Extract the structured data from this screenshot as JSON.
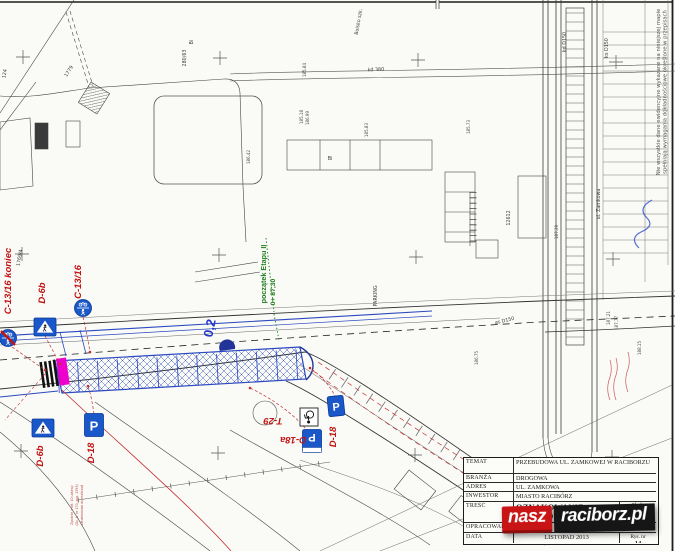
{
  "colors": {
    "design_blue": "#2b49c0",
    "sign_blue": "#1a57c8",
    "label_red": "#c21414",
    "station_green": "#1e7d1e",
    "crossing_magenta": "#ee00cc",
    "pen_blue": "#3355cc"
  },
  "map_labels": [
    "124",
    "1769/4",
    "1779",
    "280/63",
    "Bi",
    "Boisko szk.",
    "kd 380",
    "kd D150",
    "ks D150",
    "ul. Zamkowa",
    "12612",
    "øs D150",
    "PARKING",
    "185.18",
    "186.99",
    "185.83",
    "185.73",
    "187.39",
    "185.84",
    "186.42",
    "187.21",
    "187.77",
    "188.15",
    "186.75"
  ],
  "signs": {
    "c1316_koniec": "C-13/16 koniec",
    "c1316": "C-13/16",
    "d6b": "D-6b",
    "d18": "D-18",
    "d18a": "D-18a",
    "t29": "T-29",
    "p_letter": "P"
  },
  "stationing": {
    "label": "początek Etapu II",
    "chainage": "0+ 87,30"
  },
  "road_marking": {
    "width_label": "0,2"
  },
  "disclaimer": {
    "line1": "Nie wszystkie dane ewidencyjne wykazane na niniejszej mapie",
    "line2": "spełniają wymagania dokładnościowe określone w przepisach"
  },
  "legal_note": {
    "line1": "Zgodnie z art. 10 ustawy",
    "line2": "(Dz. U. nr 170, poz. 1393)",
    "line3": "zatwierdzam do realizacji"
  },
  "title_block": {
    "temat_label": "TEMAT",
    "temat_value": "PRZEBUDOWA UL. ZAMKOWEJ W RACIBORZU",
    "branza_label": "BRANŻA",
    "branza_value": "DROGOWA",
    "adres_label": "ADRES",
    "adres_value": "UL. ZAMKOWA",
    "inwestor_label": "INWESTOR",
    "inwestor_value": "MIASTO RACIBÓRZ",
    "tresc_label": "TREŚĆ",
    "tresc_value_line1": "OZNAKOWANIE",
    "tresc_value_line2": "DOCELOWE - ETAP II",
    "skala_label": "Skala",
    "skala_value": "1:500",
    "opracowal_label": "OPRACOWAŁ",
    "data_label": "DATA",
    "data_value": "LISTOPAD 2013",
    "rys_label": "Rys. nr",
    "rys_value": "14"
  },
  "watermark": {
    "word1": "nasz",
    "word2": "raciborz.pl"
  }
}
